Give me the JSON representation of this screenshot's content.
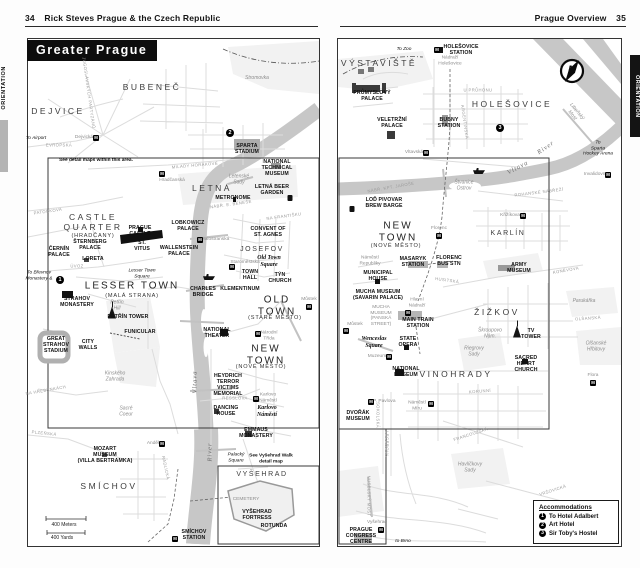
{
  "left_page": {
    "page_number": "34",
    "header": "Rick Steves Prague & the Czech Republic",
    "tab": "ORIENTATION",
    "map_title": "Greater Prague",
    "labels": [
      {
        "text": "BUBENEČ",
        "x": 152,
        "y": 88,
        "cls": "dist"
      },
      {
        "text": "DEJVICE",
        "x": 58,
        "y": 112,
        "cls": "dist"
      },
      {
        "text": "LETNÁ",
        "x": 212,
        "y": 189,
        "cls": "dist"
      },
      {
        "text": "Stromovka",
        "x": 257,
        "y": 79,
        "cls": "gray-it"
      },
      {
        "text": "CASTLE\nQUARTER",
        "x": 93,
        "y": 223,
        "cls": "dist"
      },
      {
        "text": "(HRADČANY)",
        "x": 93,
        "y": 236,
        "cls": "sub"
      },
      {
        "text": "LESSER TOWN",
        "x": 132,
        "y": 286,
        "cls": "dist-lg"
      },
      {
        "text": "(MALÁ STRANA)",
        "x": 132,
        "y": 296,
        "cls": "sub"
      },
      {
        "text": "JOSEFOV",
        "x": 262,
        "y": 250,
        "cls": "dist-sm"
      },
      {
        "text": "OLD\nTOWN",
        "x": 277,
        "y": 306,
        "cls": "dist-lg"
      },
      {
        "text": "(STARÉ MĚSTO)",
        "x": 275,
        "y": 318,
        "cls": "sub"
      },
      {
        "text": "NEW\nTOWN",
        "x": 266,
        "y": 355,
        "cls": "dist-lg"
      },
      {
        "text": "(NOVÉ MĚSTO)",
        "x": 261,
        "y": 367,
        "cls": "sub"
      },
      {
        "text": "SMÍCHOV",
        "x": 109,
        "y": 487,
        "cls": "dist"
      },
      {
        "text": "VYŠEHRAD",
        "x": 262,
        "y": 475,
        "cls": "dist-sm"
      },
      {
        "text": "To Airport",
        "x": 36,
        "y": 139,
        "cls": "tiny-it"
      },
      {
        "text": "Dejvická",
        "x": 84,
        "y": 138,
        "cls": "gray"
      },
      {
        "text": "M",
        "x": 96,
        "y": 138,
        "cls": "micon"
      },
      {
        "text": "See detail maps within this area.",
        "x": 96,
        "y": 161,
        "cls": "note"
      },
      {
        "text": "Hradčanská",
        "x": 172,
        "y": 181,
        "cls": "gray"
      },
      {
        "text": "M",
        "x": 162,
        "y": 174,
        "cls": "micon"
      },
      {
        "text": "2",
        "x": 230,
        "y": 133,
        "cls": "marker"
      },
      {
        "text": "SPARTA\nSTADIUM",
        "x": 247,
        "y": 150,
        "cls": "poi"
      },
      {
        "text": "NATIONAL\nTECHNICAL\nMUSEUM",
        "x": 277,
        "y": 169,
        "cls": "poi"
      },
      {
        "text": "Letenské\nSady",
        "x": 239,
        "y": 180,
        "cls": "gray-it"
      },
      {
        "text": "LETNÁ BEER\nGARDEN",
        "x": 272,
        "y": 191,
        "cls": "poi"
      },
      {
        "text": "",
        "x": 290,
        "y": 198,
        "cls": "i-beer"
      },
      {
        "text": "METRONOME",
        "x": 233,
        "y": 199,
        "cls": "poi"
      },
      {
        "text": "PRAGUE\nCASTLE",
        "x": 140,
        "y": 232,
        "cls": "poi"
      },
      {
        "text": "LOBKOWICZ\nPALACE",
        "x": 188,
        "y": 227,
        "cls": "poi"
      },
      {
        "text": "ŠTERNBERG\nPALACE",
        "x": 90,
        "y": 246,
        "cls": "poi"
      },
      {
        "text": "ČERNÍN\nPALACE",
        "x": 59,
        "y": 253,
        "cls": "poi"
      },
      {
        "text": "LORETA",
        "x": 93,
        "y": 260,
        "cls": "poi"
      },
      {
        "text": "ST.\nVITUS",
        "x": 142,
        "y": 247,
        "cls": "poi"
      },
      {
        "text": "WALLENSTEIN\nPALACE",
        "x": 179,
        "y": 252,
        "cls": "poi"
      },
      {
        "text": "CONVENT OF\nST. AGNES",
        "x": 268,
        "y": 233,
        "cls": "poi"
      },
      {
        "text": "Old Town\nSquare",
        "x": 269,
        "y": 262,
        "cls": "poi-it"
      },
      {
        "text": "Malostranská",
        "x": 215,
        "y": 240,
        "cls": "gray"
      },
      {
        "text": "M",
        "x": 200,
        "y": 240,
        "cls": "micon"
      },
      {
        "text": "Staroměstská",
        "x": 245,
        "y": 263,
        "cls": "gray"
      },
      {
        "text": "M",
        "x": 232,
        "y": 267,
        "cls": "micon"
      },
      {
        "text": "TOWN\nHALL",
        "x": 250,
        "y": 276,
        "cls": "poi"
      },
      {
        "text": "TÝN\nCHURCH",
        "x": 280,
        "y": 279,
        "cls": "poi"
      },
      {
        "text": "KLEMENTINUM",
        "x": 240,
        "y": 290,
        "cls": "poi"
      },
      {
        "text": "CHARLES\nBRIDGE",
        "x": 203,
        "y": 293,
        "cls": "poi"
      },
      {
        "text": "Lesser Town\nSquare",
        "x": 142,
        "y": 274,
        "cls": "tiny-it"
      },
      {
        "text": "To Břevnov\nMonastery &",
        "x": 39,
        "y": 276,
        "cls": "tiny-it"
      },
      {
        "text": "1",
        "x": 60,
        "y": 280,
        "cls": "marker"
      },
      {
        "text": "STRAHOV\nMONASTERY",
        "x": 77,
        "y": 303,
        "cls": "poi"
      },
      {
        "text": "Petřín\nHill",
        "x": 117,
        "y": 306,
        "cls": "gray-it"
      },
      {
        "text": "",
        "x": 112,
        "y": 311,
        "cls": "i-tower"
      },
      {
        "text": "PETŘÍN TOWER",
        "x": 128,
        "y": 318,
        "cls": "poi"
      },
      {
        "text": "FUNICULAR",
        "x": 140,
        "y": 333,
        "cls": "poi"
      },
      {
        "text": "Můstek",
        "x": 309,
        "y": 300,
        "cls": "gray"
      },
      {
        "text": "M",
        "x": 309,
        "y": 307,
        "cls": "micon"
      },
      {
        "text": "",
        "x": 209,
        "y": 277,
        "cls": "i-boat"
      },
      {
        "text": "GREAT\nSTRAHOV\nSTADIUM",
        "x": 56,
        "y": 346,
        "cls": "poi"
      },
      {
        "text": "CITY\nWALLS",
        "x": 88,
        "y": 346,
        "cls": "poi"
      },
      {
        "text": "Kinského\nZahrada",
        "x": 115,
        "y": 377,
        "cls": "gray-it"
      },
      {
        "text": "Sacré\nCoeur",
        "x": 126,
        "y": 412,
        "cls": "gray-it"
      },
      {
        "text": "NATIONAL\nTHEATER",
        "x": 217,
        "y": 334,
        "cls": "poi"
      },
      {
        "text": "Národní\nTřída",
        "x": 269,
        "y": 336,
        "cls": "gray"
      },
      {
        "text": "M",
        "x": 258,
        "y": 334,
        "cls": "micon"
      },
      {
        "text": "HEYDRICH\nTERROR\nVICTIMS\nMEMORIAL",
        "x": 228,
        "y": 386,
        "cls": "poi"
      },
      {
        "text": "DANCING\nHOUSE",
        "x": 226,
        "y": 412,
        "cls": "poi"
      },
      {
        "text": "Karlovo\nNáměstí",
        "x": 268,
        "y": 398,
        "cls": "gray"
      },
      {
        "text": "M",
        "x": 256,
        "y": 399,
        "cls": "micon"
      },
      {
        "text": "Karlovo\nNáměstí",
        "x": 267,
        "y": 412,
        "cls": "poi-it"
      },
      {
        "text": "EMMAUS\nMONASTERY",
        "x": 256,
        "y": 434,
        "cls": "poi"
      },
      {
        "text": "Palacký\nSquare",
        "x": 236,
        "y": 458,
        "cls": "tiny-it"
      },
      {
        "text": "See Vyšehrad Walk\ndetail map",
        "x": 271,
        "y": 459,
        "cls": "note"
      },
      {
        "text": "CEMETERY",
        "x": 246,
        "y": 500,
        "cls": "gray"
      },
      {
        "text": "VYŠEHRAD\nFORTRESS",
        "x": 257,
        "y": 516,
        "cls": "poi"
      },
      {
        "text": "ROTUNDA",
        "x": 274,
        "y": 527,
        "cls": "poi"
      },
      {
        "text": "SMÍCHOV\nSTATION",
        "x": 194,
        "y": 536,
        "cls": "poi"
      },
      {
        "text": "M",
        "x": 175,
        "y": 539,
        "cls": "micon"
      },
      {
        "text": "MOZART\nMUSEUM\n(VILLA BERTRAMKA)",
        "x": 105,
        "y": 456,
        "cls": "poi"
      },
      {
        "text": "Anděl",
        "x": 153,
        "y": 444,
        "cls": "gray"
      },
      {
        "text": "M",
        "x": 162,
        "y": 444,
        "cls": "micon"
      },
      {
        "text": "Vltava",
        "x": 195,
        "y": 382,
        "cls": "riv",
        "rot": -90
      },
      {
        "text": "River",
        "x": 210,
        "y": 452,
        "cls": "riv",
        "rot": -90
      },
      {
        "text": "400 Meters",
        "x": 64,
        "y": 526,
        "cls": "scale"
      },
      {
        "text": "400 Yards",
        "x": 62,
        "y": 539,
        "cls": "scale"
      },
      {
        "text": "EVROPSKÁ",
        "x": 59,
        "y": 146,
        "cls": "street"
      },
      {
        "text": "JUGOSLÁVSKÝCH PARTYZÁNŮ",
        "x": 88,
        "y": 93,
        "cls": "street",
        "rot": 82
      },
      {
        "text": "PATOČKOVA",
        "x": 48,
        "y": 212,
        "cls": "street",
        "rot": -8
      },
      {
        "text": "MILADY HORÁKOVÉ",
        "x": 195,
        "y": 166,
        "cls": "street",
        "rot": -5
      },
      {
        "text": "NÁBŘ. E. BENEŠE",
        "x": 231,
        "y": 205,
        "cls": "street",
        "rot": -8
      },
      {
        "text": "NA FRANTIŠKU",
        "x": 284,
        "y": 217,
        "cls": "street",
        "rot": -8
      },
      {
        "text": "ÚVOZ",
        "x": 77,
        "y": 267,
        "cls": "street"
      },
      {
        "text": "NA HŘEBENKÁCH",
        "x": 46,
        "y": 391,
        "cls": "street",
        "rot": -10
      },
      {
        "text": "PLZEŇSKÁ",
        "x": 44,
        "y": 434,
        "cls": "street",
        "rot": 6
      },
      {
        "text": "RADLICKÁ",
        "x": 165,
        "y": 468,
        "cls": "street",
        "rot": 78
      },
      {
        "text": "RESSLOVA",
        "x": 235,
        "y": 399,
        "cls": "street"
      }
    ]
  },
  "right_page": {
    "page_number": "35",
    "header": "Prague Overview",
    "tab": "ORIENTATION",
    "compass_label": "N",
    "legend": {
      "title": "Accommodations",
      "items": [
        {
          "num": "1",
          "label": "To Hotel Adalbert"
        },
        {
          "num": "2",
          "label": "Art Hotel"
        },
        {
          "num": "3",
          "label": "Sir Toby's Hostel"
        }
      ]
    },
    "labels": [
      {
        "text": "VÝSTAVIŠTĚ",
        "x": 379,
        "y": 64,
        "cls": "dist"
      },
      {
        "text": "To Zoo",
        "x": 404,
        "y": 50,
        "cls": "tiny-it"
      },
      {
        "text": "HOLEŠOVICE\nSTATION",
        "x": 461,
        "y": 51,
        "cls": "poi"
      },
      {
        "text": "M",
        "x": 437,
        "y": 50,
        "cls": "micon"
      },
      {
        "text": "Nádraží\nHolešovice",
        "x": 450,
        "y": 61,
        "cls": "gray"
      },
      {
        "text": "HOLEŠOVICE",
        "x": 512,
        "y": 105,
        "cls": "dist"
      },
      {
        "text": "PRŮMYSLOVÝ\nPALACE",
        "x": 372,
        "y": 97,
        "cls": "poi"
      },
      {
        "text": "VELETRŽNÍ\nPALACE",
        "x": 392,
        "y": 124,
        "cls": "poi"
      },
      {
        "text": "BUBNY\nSTATION",
        "x": 449,
        "y": 124,
        "cls": "poi"
      },
      {
        "text": "3",
        "x": 500,
        "y": 128,
        "cls": "marker"
      },
      {
        "text": "Vltavská",
        "x": 414,
        "y": 153,
        "cls": "gray"
      },
      {
        "text": "M",
        "x": 426,
        "y": 153,
        "cls": "micon"
      },
      {
        "text": "Štvanice\nOstrov",
        "x": 464,
        "y": 186,
        "cls": "gray-it"
      },
      {
        "text": "",
        "x": 479,
        "y": 171,
        "cls": "i-boat"
      },
      {
        "text": "LOĎ PIVOVAR\nBREW BARGE",
        "x": 384,
        "y": 204,
        "cls": "poi"
      },
      {
        "text": "",
        "x": 352,
        "y": 209,
        "cls": "i-beer"
      },
      {
        "text": "Vltava",
        "x": 518,
        "y": 168,
        "cls": "riv",
        "rot": -28
      },
      {
        "text": "River",
        "x": 546,
        "y": 148,
        "cls": "riv",
        "rot": -35
      },
      {
        "text": "Libeňský\nMost",
        "x": 574,
        "y": 114,
        "cls": "gray-it",
        "rot": 50
      },
      {
        "text": "To\nSparta\nHockey Arena",
        "x": 598,
        "y": 149,
        "cls": "tiny-it"
      },
      {
        "text": "Invalidovna",
        "x": 596,
        "y": 175,
        "cls": "gray"
      },
      {
        "text": "M",
        "x": 608,
        "y": 175,
        "cls": "micon"
      },
      {
        "text": "NEW\nTOWN",
        "x": 398,
        "y": 232,
        "cls": "dist-lg"
      },
      {
        "text": "(NOVÉ MĚSTO)",
        "x": 396,
        "y": 246,
        "cls": "sub"
      },
      {
        "text": "KARLÍN",
        "x": 508,
        "y": 234,
        "cls": "dist-sm"
      },
      {
        "text": "Křižíkova",
        "x": 510,
        "y": 216,
        "cls": "gray"
      },
      {
        "text": "M",
        "x": 523,
        "y": 216,
        "cls": "micon"
      },
      {
        "text": "Florenc",
        "x": 439,
        "y": 229,
        "cls": "gray"
      },
      {
        "text": "M",
        "x": 439,
        "y": 236,
        "cls": "micon"
      },
      {
        "text": "Náměstí\nRepubliky",
        "x": 370,
        "y": 261,
        "cls": "gray"
      },
      {
        "text": "MASARYK\nSTATION",
        "x": 413,
        "y": 263,
        "cls": "poi"
      },
      {
        "text": "FLORENC\nBUS STN",
        "x": 449,
        "y": 262,
        "cls": "poi"
      },
      {
        "text": "MUNICIPAL\nHOUSE",
        "x": 378,
        "y": 277,
        "cls": "poi"
      },
      {
        "text": "MUCHA MUSEUM\n(SAVARIN PALACE)",
        "x": 378,
        "y": 296,
        "cls": "poi"
      },
      {
        "text": "MUCHA\nMUSEUM\n(PANSKÁ\nSTREET)",
        "x": 381,
        "y": 316,
        "cls": "gray"
      },
      {
        "text": "Hlavní\nNádraží",
        "x": 417,
        "y": 303,
        "cls": "gray"
      },
      {
        "text": "M",
        "x": 408,
        "y": 313,
        "cls": "micon"
      },
      {
        "text": "MAIN TRAIN\nSTATION",
        "x": 418,
        "y": 324,
        "cls": "poi"
      },
      {
        "text": "Můstek",
        "x": 355,
        "y": 325,
        "cls": "gray"
      },
      {
        "text": "M",
        "x": 346,
        "y": 331,
        "cls": "micon"
      },
      {
        "text": "Wenceslas\nSquare",
        "x": 374,
        "y": 343,
        "cls": "poi-it"
      },
      {
        "text": "STATE\nOPERA",
        "x": 408,
        "y": 343,
        "cls": "poi"
      },
      {
        "text": "Muzeum",
        "x": 377,
        "y": 357,
        "cls": "gray"
      },
      {
        "text": "M",
        "x": 389,
        "y": 357,
        "cls": "micon"
      },
      {
        "text": "NATIONAL\nMUSEUM",
        "x": 406,
        "y": 373,
        "cls": "poi"
      },
      {
        "text": "ŽIŽKOV",
        "x": 497,
        "y": 313,
        "c ls": "dist"
      },
      {
        "text": "ARMY\nMUSEUM",
        "x": 519,
        "y": 269,
        "cls": "poi"
      },
      {
        "text": "Škroupovo\nNám.",
        "x": 490,
        "y": 334,
        "cls": "gray-it"
      },
      {
        "text": "Riegrovy\nSady",
        "x": 474,
        "y": 352,
        "cls": "gray-it"
      },
      {
        "text": "",
        "x": 517,
        "y": 330,
        "cls": "i-tower"
      },
      {
        "text": "TV\nTOWER",
        "x": 531,
        "y": 335,
        "cls": "poi"
      },
      {
        "text": "SACRED\nHEART\nCHURCH",
        "x": 526,
        "y": 365,
        "cls": "poi"
      },
      {
        "text": "Parukářka",
        "x": 584,
        "y": 302,
        "cls": "gray-it"
      },
      {
        "text": "Olšanské\nHřbitovy",
        "x": 596,
        "y": 347,
        "cls": "gray-it"
      },
      {
        "text": "Flora",
        "x": 593,
        "y": 376,
        "cls": "gray"
      },
      {
        "text": "M",
        "x": 593,
        "y": 383,
        "cls": "micon"
      },
      {
        "text": "VINOHRADY",
        "x": 456,
        "y": 375,
        "cls": "dist"
      },
      {
        "text": "I.P. Pavlova",
        "x": 383,
        "y": 402,
        "cls": "gray"
      },
      {
        "text": "M",
        "x": 371,
        "y": 402,
        "cls": "micon"
      },
      {
        "text": "Náměstí\nMíru",
        "x": 417,
        "y": 406,
        "cls": "gray"
      },
      {
        "text": "M",
        "x": 431,
        "y": 404,
        "cls": "micon"
      },
      {
        "text": "DVOŘÁK\nMUSEUM",
        "x": 358,
        "y": 417,
        "cls": "poi"
      },
      {
        "text": "Havlíčkovy\nSady",
        "x": 470,
        "y": 468,
        "cls": "gray-it"
      },
      {
        "text": "Vyšehrad",
        "x": 377,
        "y": 523,
        "cls": "gray"
      },
      {
        "text": "M",
        "x": 381,
        "y": 530,
        "cls": "micon"
      },
      {
        "text": "PRAGUE\nCONGRESS\nCENTRE",
        "x": 361,
        "y": 537,
        "cls": "poi"
      },
      {
        "text": "to Brno",
        "x": 403,
        "y": 542,
        "cls": "tiny-it"
      },
      {
        "text": "ROHANSKÉ NÁBŘEŽÍ",
        "x": 539,
        "y": 193,
        "cls": "street",
        "rot": -7
      },
      {
        "text": "NÁBŘ. KPT. JAROŠE",
        "x": 391,
        "y": 188,
        "cls": "street",
        "rot": -10
      },
      {
        "text": "U PRŮHONU",
        "x": 478,
        "y": 91,
        "cls": "street"
      },
      {
        "text": "ARGENTINSKÁ",
        "x": 464,
        "y": 122,
        "cls": "street",
        "rot": 82
      },
      {
        "text": "KONĚVOVA",
        "x": 566,
        "y": 271,
        "cls": "street",
        "rot": -10
      },
      {
        "text": "HUSITSKÁ",
        "x": 447,
        "y": 281,
        "cls": "street",
        "rot": 8
      },
      {
        "text": "OLŠANSKÁ",
        "x": 588,
        "y": 319,
        "cls": "street",
        "rot": -4
      },
      {
        "text": "KORUNNÍ",
        "x": 480,
        "y": 392,
        "cls": "street",
        "rot": -4
      },
      {
        "text": "FRANCOUZSKÁ",
        "x": 471,
        "y": 435,
        "cls": "street",
        "rot": -18
      },
      {
        "text": "VRŠOVICKÁ",
        "x": 553,
        "y": 491,
        "cls": "street",
        "rot": -18
      },
      {
        "text": "LEGEROVA",
        "x": 386,
        "y": 444,
        "cls": "street",
        "rot": 90
      },
      {
        "text": "SOKOLSKÁ",
        "x": 377,
        "y": 415,
        "cls": "street",
        "rot": 90
      },
      {
        "text": "NUSELSKÝ MOST",
        "x": 368,
        "y": 496,
        "cls": "street",
        "rot": 90
      }
    ]
  }
}
